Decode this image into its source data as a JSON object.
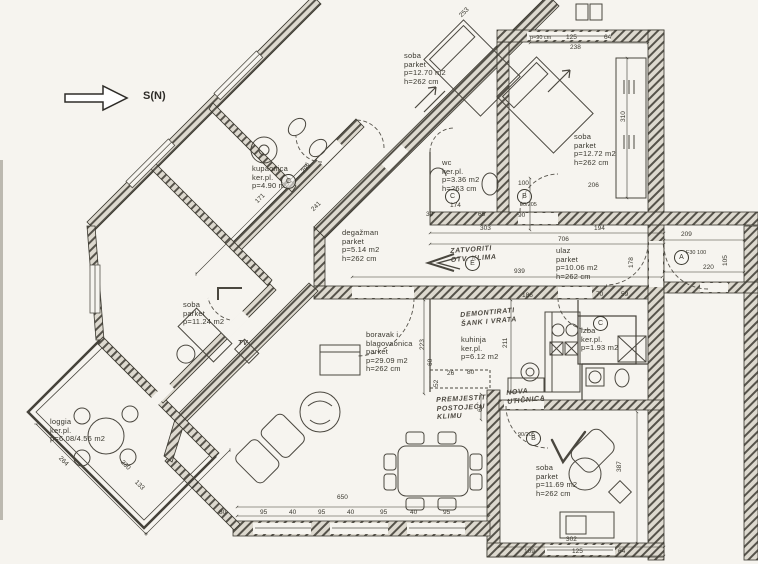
{
  "title": "Stambeni tlocrt (skenirani arhitektonski nacrt)",
  "colors": {
    "ink": "#3a382f",
    "scan_bg": "#f6f4ef",
    "wall_hatch": "#56534b"
  },
  "compass": {
    "label": "S(N)"
  },
  "rooms": [
    {
      "name": "soba",
      "lines": [
        "soba",
        "parket",
        "p=12.70 m2",
        "h=262 cm"
      ]
    },
    {
      "name": "soba",
      "lines": [
        "soba",
        "parket",
        "p=12.72 m2",
        "h=262 cm"
      ]
    },
    {
      "name": "kupaonica",
      "lines": [
        "kupaonica",
        "ker.pl.",
        "p=4.90 m2"
      ]
    },
    {
      "name": "wc",
      "lines": [
        "wc",
        "ker.pl.",
        "p=3.36 m2",
        "h=263 cm"
      ]
    },
    {
      "name": "degazman",
      "lines": [
        "degažman",
        "parket",
        "p=5.14 m2",
        "h=262 cm"
      ]
    },
    {
      "name": "ulaz",
      "lines": [
        "ulaz",
        "parket",
        "p=10.06 m2",
        "h=262 cm"
      ]
    },
    {
      "name": "soba",
      "lines": [
        "soba",
        "parket",
        "p=11.24 m2"
      ]
    },
    {
      "name": "loggia",
      "lines": [
        "loggia",
        "ker.pl.",
        "p=6.08/4.56 m2"
      ]
    },
    {
      "name": "boravak",
      "lines": [
        "boravak i",
        "blagovaonica",
        "parket",
        "p=29.09 m2",
        "h=262 cm"
      ]
    },
    {
      "name": "kuhinja",
      "lines": [
        "kuhinja",
        "ker.pl.",
        "p=6.12 m2"
      ]
    },
    {
      "name": "izba",
      "lines": [
        "izba",
        "ker.pl.",
        "p=1.93 m2"
      ]
    },
    {
      "name": "soba",
      "lines": [
        "soba",
        "parket",
        "p=11.69 m2",
        "h=262 cm"
      ]
    }
  ],
  "handwritten": [
    {
      "lines": [
        "ZATVORITI",
        "OTV. KLIMA"
      ]
    },
    {
      "lines": [
        "DEMONTIRATI",
        "ŠANK I VRATA"
      ]
    },
    {
      "lines": [
        "PREMJESTITI",
        "POSTOJEĆU",
        "KLIMU"
      ]
    },
    {
      "lines": [
        "NOVA",
        "UTIČNICA"
      ]
    },
    {
      "lines": [
        "TV"
      ]
    }
  ],
  "markers": [
    "C",
    "C",
    "B",
    "E",
    "A",
    "C",
    "B"
  ],
  "dims": [
    "650",
    "80",
    "95",
    "40",
    "95",
    "40",
    "95",
    "40",
    "95",
    "303",
    "194",
    "706",
    "939",
    "209",
    "220",
    "105",
    "178",
    "F30 100",
    "186",
    "211",
    "80",
    "26",
    "223",
    "60",
    "52",
    "65",
    "70",
    "59",
    "90",
    "100",
    "174",
    "65",
    "39",
    "206",
    "310",
    "238",
    "125",
    "p=90 cm",
    "64",
    "387",
    "302",
    "109",
    "125",
    "64",
    "264",
    "230",
    "133",
    "298",
    "241",
    "253",
    "171",
    "90/205",
    "90/205"
  ]
}
